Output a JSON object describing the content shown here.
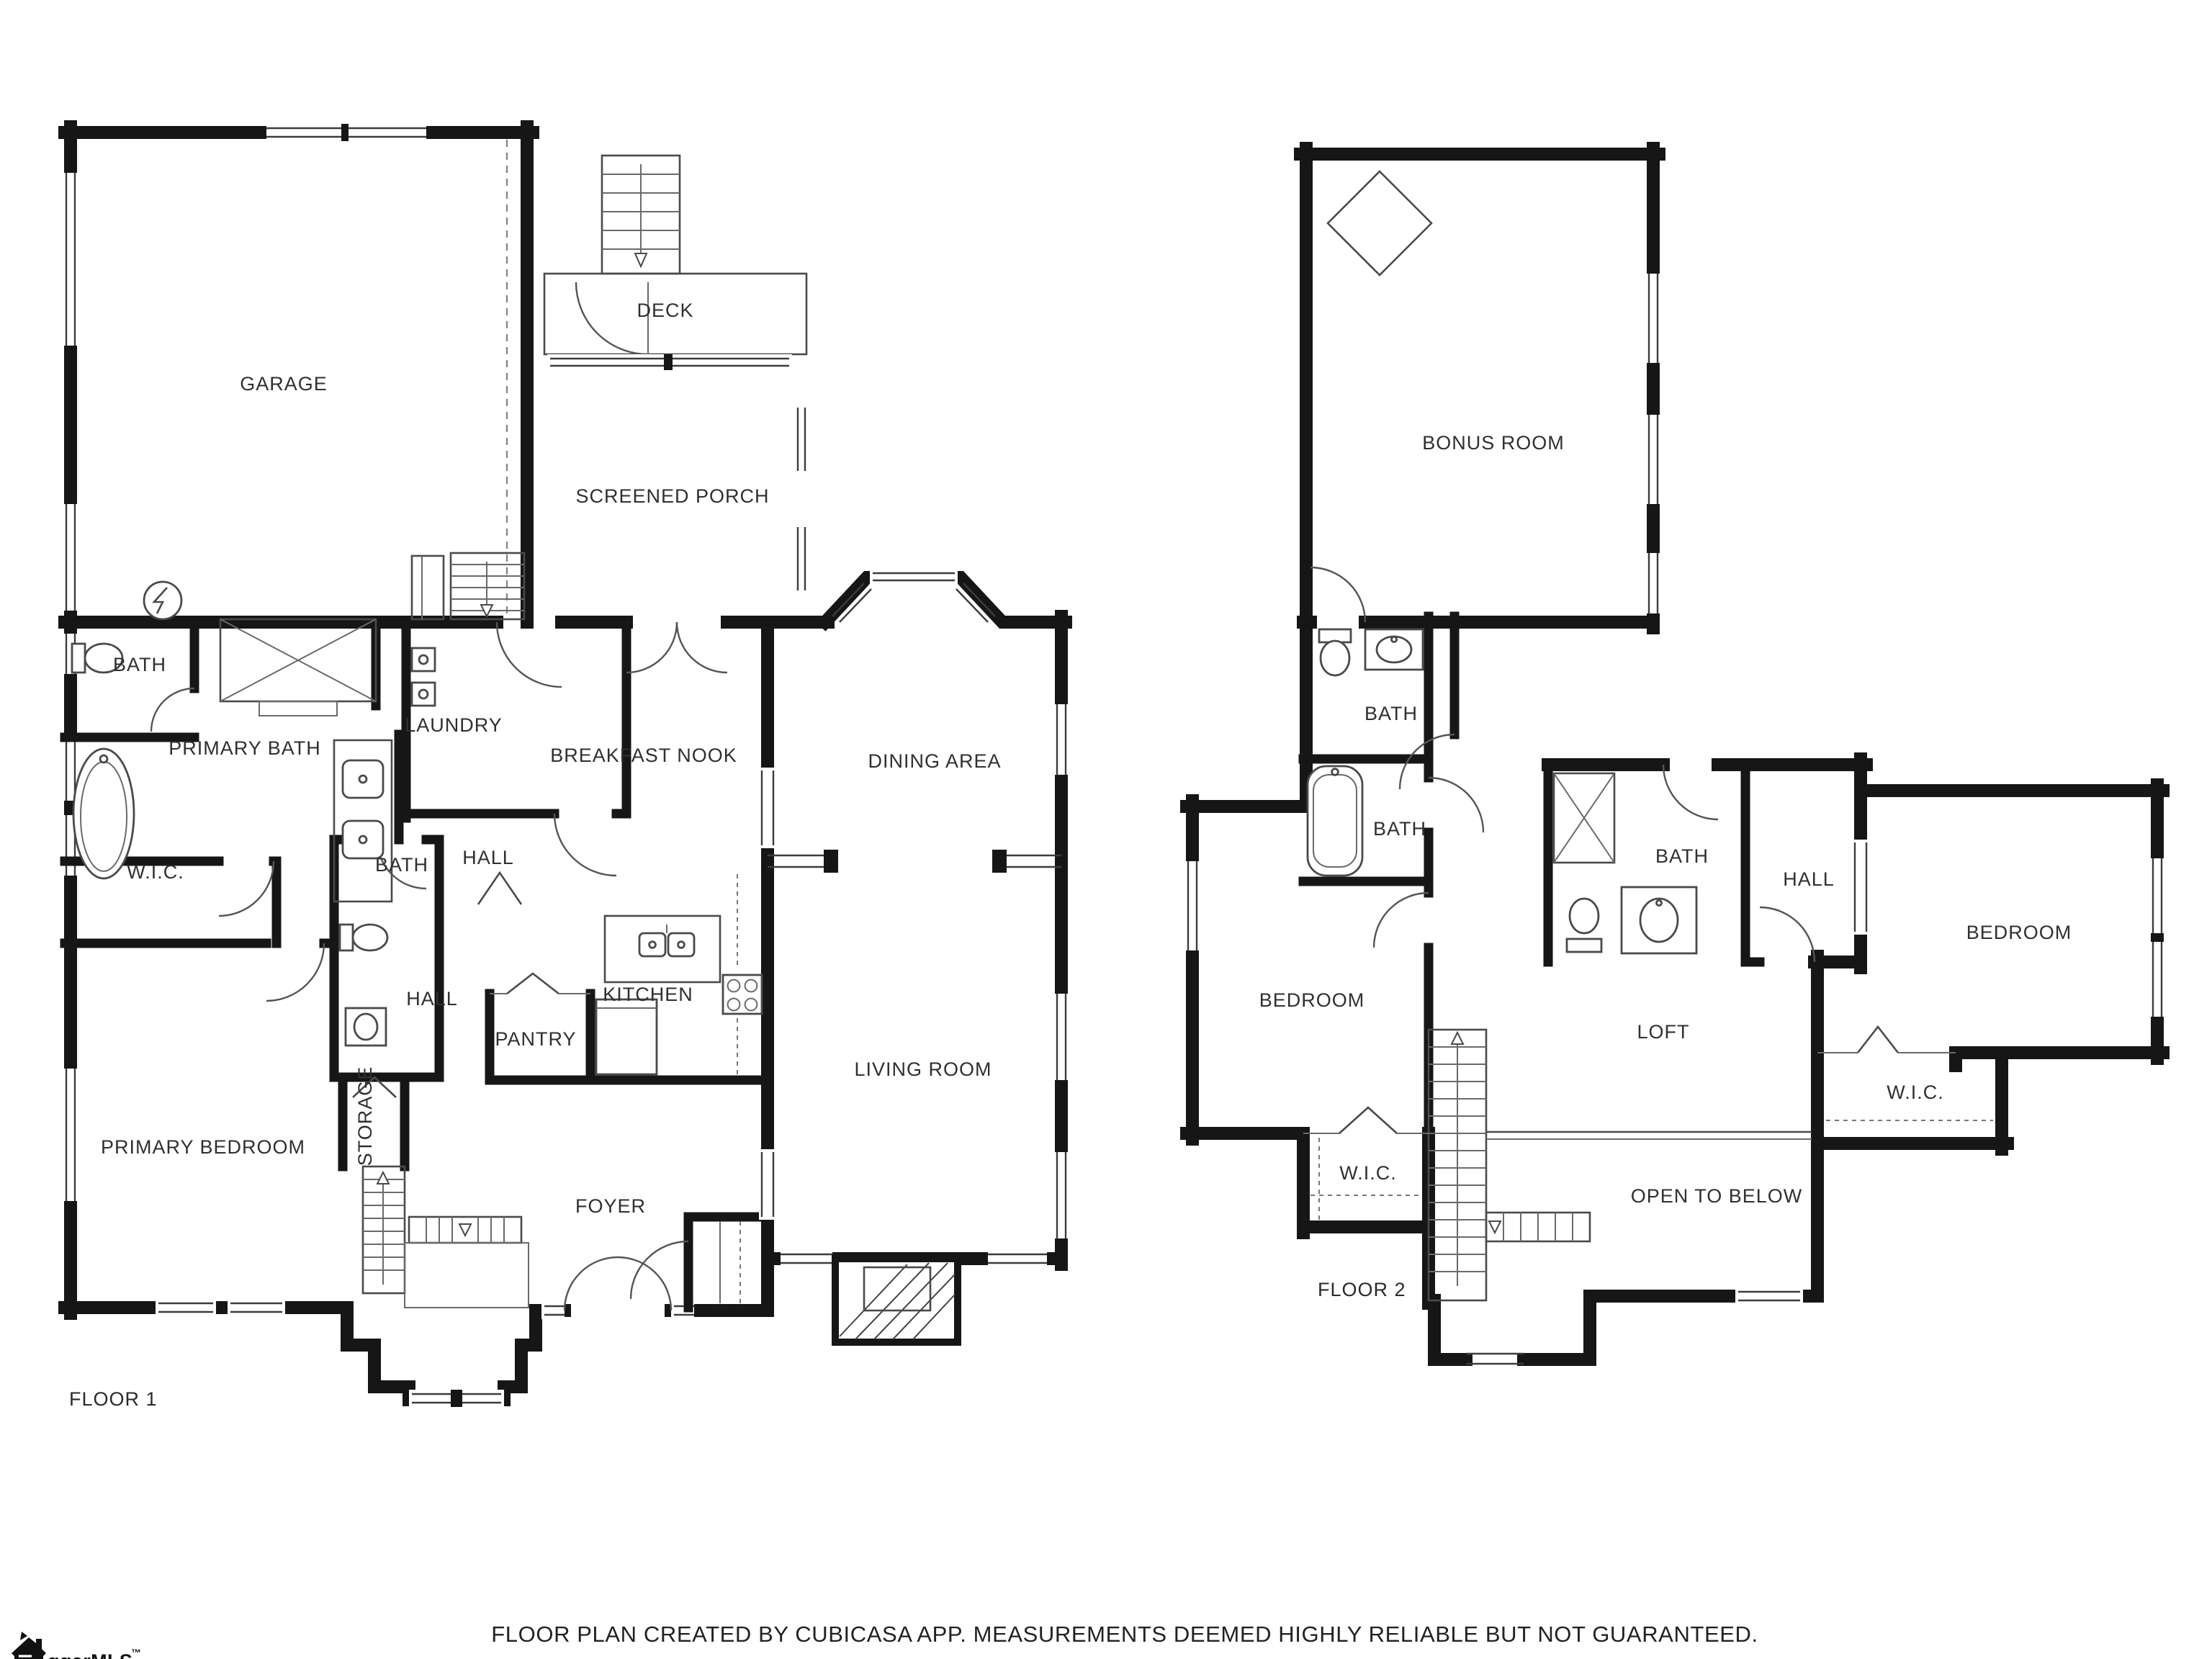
{
  "colors": {
    "wall": "#161616",
    "thin_line": "#4a4a4a",
    "text": "#303030",
    "background": "#ffffff"
  },
  "floors": [
    {
      "caption": "FLOOR 1",
      "rooms": [
        {
          "label": "GARAGE"
        },
        {
          "label": "DECK"
        },
        {
          "label": "SCREENED PORCH"
        },
        {
          "label": "BATH"
        },
        {
          "label": "PRIMARY BATH"
        },
        {
          "label": "LAUNDRY"
        },
        {
          "label": "BREAKFAST NOOK"
        },
        {
          "label": "DINING AREA"
        },
        {
          "label": "W.I.C."
        },
        {
          "label": "BATH"
        },
        {
          "label": "HALL"
        },
        {
          "label": "HALL"
        },
        {
          "label": "KITCHEN"
        },
        {
          "label": "PANTRY"
        },
        {
          "label": "STORAGE"
        },
        {
          "label": "LIVING ROOM"
        },
        {
          "label": "PRIMARY BEDROOM"
        },
        {
          "label": "FOYER"
        }
      ]
    },
    {
      "caption": "FLOOR 2",
      "rooms": [
        {
          "label": "BONUS ROOM"
        },
        {
          "label": "BATH"
        },
        {
          "label": "BATH"
        },
        {
          "label": "BATH"
        },
        {
          "label": "HALL"
        },
        {
          "label": "BEDROOM"
        },
        {
          "label": "BEDROOM"
        },
        {
          "label": "LOFT"
        },
        {
          "label": "W.I.C."
        },
        {
          "label": "W.I.C."
        },
        {
          "label": "OPEN TO BELOW"
        }
      ]
    }
  ],
  "footer": {
    "disclaimer": "FLOOR PLAN CREATED BY CUBICASA APP. MEASUREMENTS DEEMED HIGHLY RELIABLE BUT NOT GUARANTEED."
  },
  "logo": {
    "text": "ggarMLS",
    "tm": "™"
  }
}
